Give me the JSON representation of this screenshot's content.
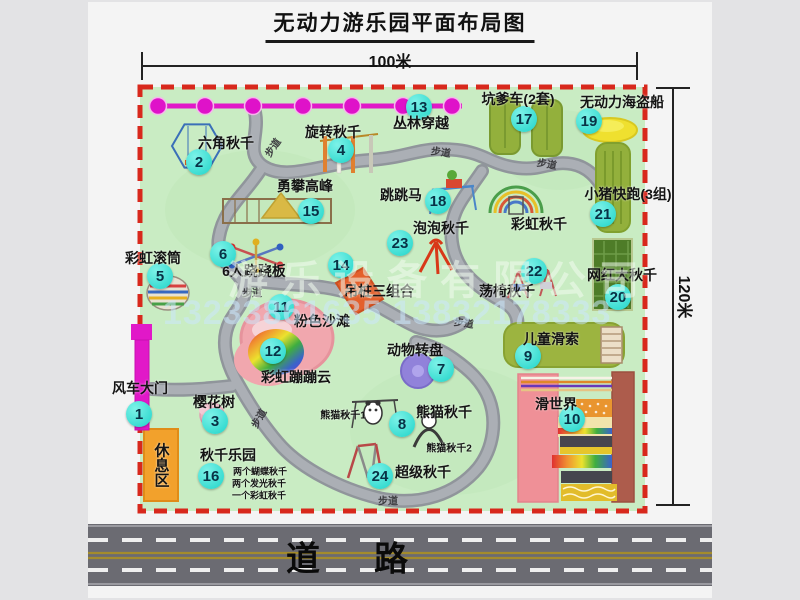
{
  "title": "无动力游乐园平面布局图",
  "dimensions": {
    "width": "100米",
    "height": "120米"
  },
  "road_label": "道　路",
  "watermark": {
    "company": "游乐设备有限公司",
    "phone": "13233861635 13832178333"
  },
  "colors": {
    "park_green": "#c9ecc3",
    "border_red": "#d8281c",
    "badge_cyan": "#2adcd1",
    "path_gray": "#a2a6ac",
    "gate_magenta": "#e118c8",
    "rest_orange": "#f2a12c",
    "road_gray": "#6b6b72",
    "pirate_yellow": "#efe02f",
    "beach_pink": "#f1a7ae"
  },
  "park": {
    "path_label_text": "步道",
    "features": [
      {
        "num": "1",
        "name": "风车大门",
        "marker": {
          "x": 139,
          "y": 414
        },
        "label": {
          "x": 140,
          "y": 388
        }
      },
      {
        "num": "2",
        "name": "六角秋千",
        "marker": {
          "x": 199,
          "y": 162
        },
        "label": {
          "x": 226,
          "y": 143
        }
      },
      {
        "num": "3",
        "name": "樱花树",
        "marker": {
          "x": 215,
          "y": 421
        },
        "label": {
          "x": 214,
          "y": 402
        }
      },
      {
        "num": "4",
        "name": "旋转秋千",
        "marker": {
          "x": 341,
          "y": 150
        },
        "label": {
          "x": 333,
          "y": 132
        }
      },
      {
        "num": "5",
        "name": "彩虹滚筒",
        "marker": {
          "x": 160,
          "y": 276
        },
        "label": {
          "x": 153,
          "y": 258
        }
      },
      {
        "num": "6",
        "name": "6人跷跷板",
        "marker": {
          "x": 223,
          "y": 254
        },
        "label": {
          "x": 254,
          "y": 271
        }
      },
      {
        "num": "7",
        "name": "动物转盘",
        "marker": {
          "x": 441,
          "y": 369
        },
        "label": {
          "x": 415,
          "y": 350
        }
      },
      {
        "num": "8",
        "name": "熊猫秋千",
        "marker": {
          "x": 402,
          "y": 424
        },
        "label": {
          "x": 444,
          "y": 412
        }
      },
      {
        "num": "9",
        "name": "儿童滑索",
        "marker": {
          "x": 528,
          "y": 356
        },
        "label": {
          "x": 551,
          "y": 339
        }
      },
      {
        "num": "10",
        "name": "滑世界",
        "marker": {
          "x": 572,
          "y": 419
        },
        "label": {
          "x": 556,
          "y": 404
        }
      },
      {
        "num": "11",
        "name": "粉色沙滩",
        "marker": {
          "x": 281,
          "y": 307
        },
        "label": {
          "x": 322,
          "y": 321
        }
      },
      {
        "num": "12",
        "name": "彩虹蹦蹦云",
        "marker": {
          "x": 273,
          "y": 351
        },
        "label": {
          "x": 296,
          "y": 377
        }
      },
      {
        "num": "13",
        "name": "丛林穿越",
        "marker": {
          "x": 419,
          "y": 107
        },
        "label": {
          "x": 421,
          "y": 123
        }
      },
      {
        "num": "14",
        "name": "吊桩三组合",
        "marker": {
          "x": 341,
          "y": 265
        },
        "label": {
          "x": 379,
          "y": 291
        }
      },
      {
        "num": "15",
        "name": "勇攀高峰",
        "marker": {
          "x": 311,
          "y": 211
        },
        "label": {
          "x": 305,
          "y": 186
        }
      },
      {
        "num": "16",
        "name": "秋千乐园",
        "marker": {
          "x": 211,
          "y": 476
        },
        "label": {
          "x": 228,
          "y": 455
        }
      },
      {
        "num": "17",
        "name": "坑爹车(2套)",
        "marker": {
          "x": 524,
          "y": 119
        },
        "label": {
          "x": 518,
          "y": 99
        }
      },
      {
        "num": "18",
        "name": "跳跳马",
        "marker": {
          "x": 438,
          "y": 201
        },
        "label": {
          "x": 401,
          "y": 195
        }
      },
      {
        "num": "19",
        "name": "无动力海盗船",
        "marker": {
          "x": 589,
          "y": 121
        },
        "label": {
          "x": 622,
          "y": 102
        }
      },
      {
        "num": "20",
        "name": "网红大秋千",
        "marker": {
          "x": 618,
          "y": 297
        },
        "label": {
          "x": 622,
          "y": 275
        }
      },
      {
        "num": "21",
        "name": "小猪快跑(3组)",
        "marker": {
          "x": 603,
          "y": 214
        },
        "label": {
          "x": 628,
          "y": 194
        }
      },
      {
        "num": "22",
        "name": "荡椅秋千",
        "marker": {
          "x": 534,
          "y": 271
        },
        "label": {
          "x": 507,
          "y": 291
        }
      },
      {
        "num": "23",
        "name": "泡泡秋千",
        "marker": {
          "x": 400,
          "y": 243
        },
        "label": {
          "x": 441,
          "y": 228
        }
      },
      {
        "num": "24",
        "name": "超级秋千",
        "marker": {
          "x": 380,
          "y": 476
        },
        "label": {
          "x": 423,
          "y": 472
        }
      }
    ],
    "extra_labels": [
      {
        "text": "彩虹秋千",
        "x": 539,
        "y": 224
      },
      {
        "text": "熊猫秋千1",
        "x": 343,
        "y": 414,
        "size": 10
      },
      {
        "text": "熊猫秋千2",
        "x": 449,
        "y": 447,
        "size": 10
      },
      {
        "text": "休息区",
        "x": 161,
        "y": 465,
        "size": 15,
        "vertical": true
      },
      {
        "text": "两个蝴蝶秋千",
        "x": 260,
        "y": 471,
        "size": 9
      },
      {
        "text": "两个发光秋千",
        "x": 259,
        "y": 483,
        "size": 9
      },
      {
        "text": "一个彩虹秋千",
        "x": 259,
        "y": 495,
        "size": 9
      }
    ],
    "path_labels": [
      {
        "x": 272,
        "y": 147,
        "rot": -55
      },
      {
        "x": 441,
        "y": 151,
        "rot": 8
      },
      {
        "x": 547,
        "y": 163,
        "rot": 10
      },
      {
        "x": 252,
        "y": 292,
        "rot": 0
      },
      {
        "x": 464,
        "y": 322,
        "rot": 8
      },
      {
        "x": 388,
        "y": 500,
        "rot": 0
      },
      {
        "x": 258,
        "y": 418,
        "rot": -60
      }
    ]
  }
}
